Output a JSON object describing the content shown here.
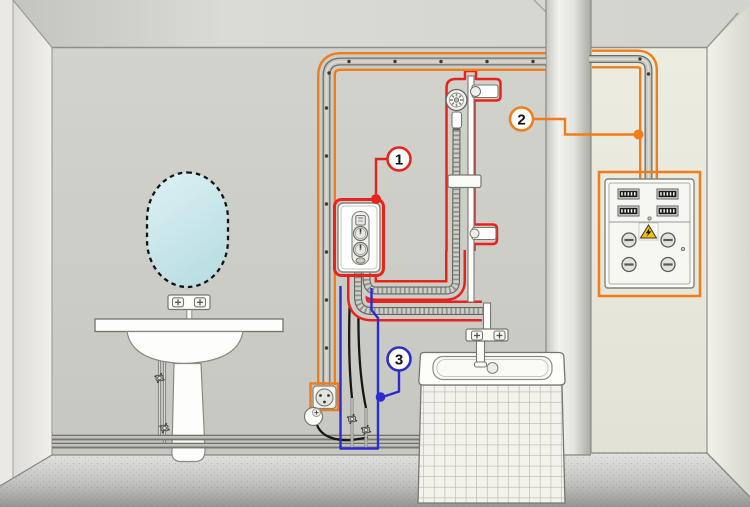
{
  "scene": {
    "name": "bathroom-electric-water-heater-installation-diagram"
  },
  "callouts": {
    "item1": {
      "number": "1",
      "color": "#e8231d",
      "target": "water-heater"
    },
    "item2": {
      "number": "2",
      "color": "#f07d1a",
      "target": "electrical-panel"
    },
    "item3": {
      "number": "3",
      "color": "#2b2bd0",
      "target": "cold-water-supply-valves"
    }
  }
}
